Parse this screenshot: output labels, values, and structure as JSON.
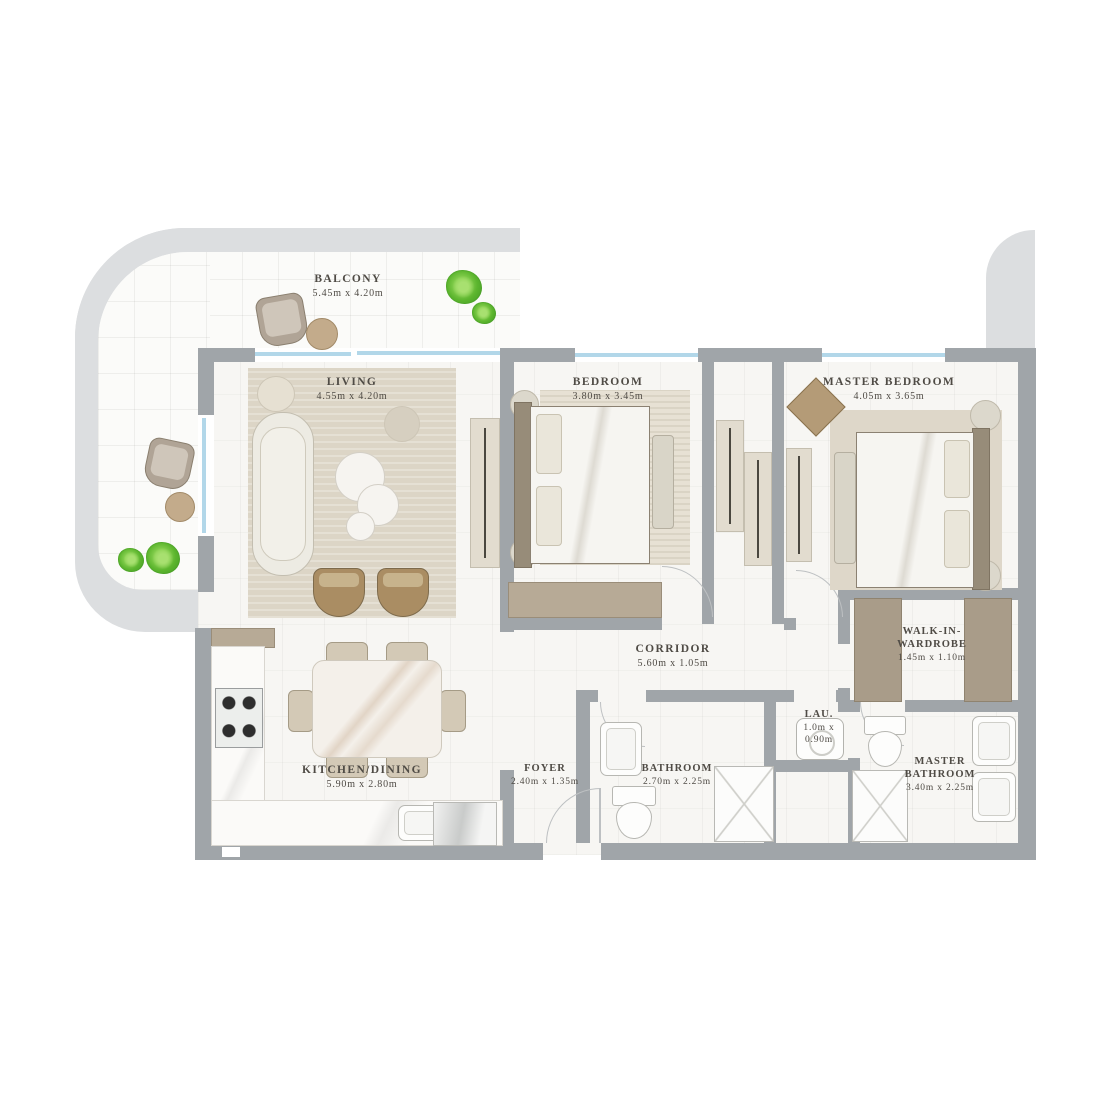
{
  "plan": {
    "title": "2 bedroom apartment floor plan",
    "rooms": [
      {
        "name": "BALCONY",
        "dims": "5.45m x 4.20m"
      },
      {
        "name": "LIVING",
        "dims": "4.55m x 4.20m"
      },
      {
        "name": "BEDROOM",
        "dims": "3.80m x 3.45m"
      },
      {
        "name": "MASTER BEDROOM",
        "dims": "4.05m x 3.65m"
      },
      {
        "name": "CORRIDOR",
        "dims": "5.60m x 1.05m"
      },
      {
        "name": "KITCHEN/DINING",
        "dims": "5.90m x 2.80m"
      },
      {
        "name": "FOYER",
        "dims": "2.40m x 1.35m"
      },
      {
        "name": "BATHROOM",
        "dims": "2.70m x 2.25m"
      },
      {
        "name": "LAU.",
        "dims": "1.0m x 0.90m"
      },
      {
        "name": "WALK-IN-WARDROBE",
        "dims": "1.45m x 1.10m"
      },
      {
        "name": "MASTER BATHROOM",
        "dims": "3.40m x 2.25m"
      }
    ],
    "colors": {
      "wall": "#a0a5a9",
      "silhouette": "#dcdee0",
      "glazing": "#b2d7e9",
      "floor": "#f7f6f3",
      "rug": "#dcd5c6",
      "text": "#4f4b45"
    }
  }
}
